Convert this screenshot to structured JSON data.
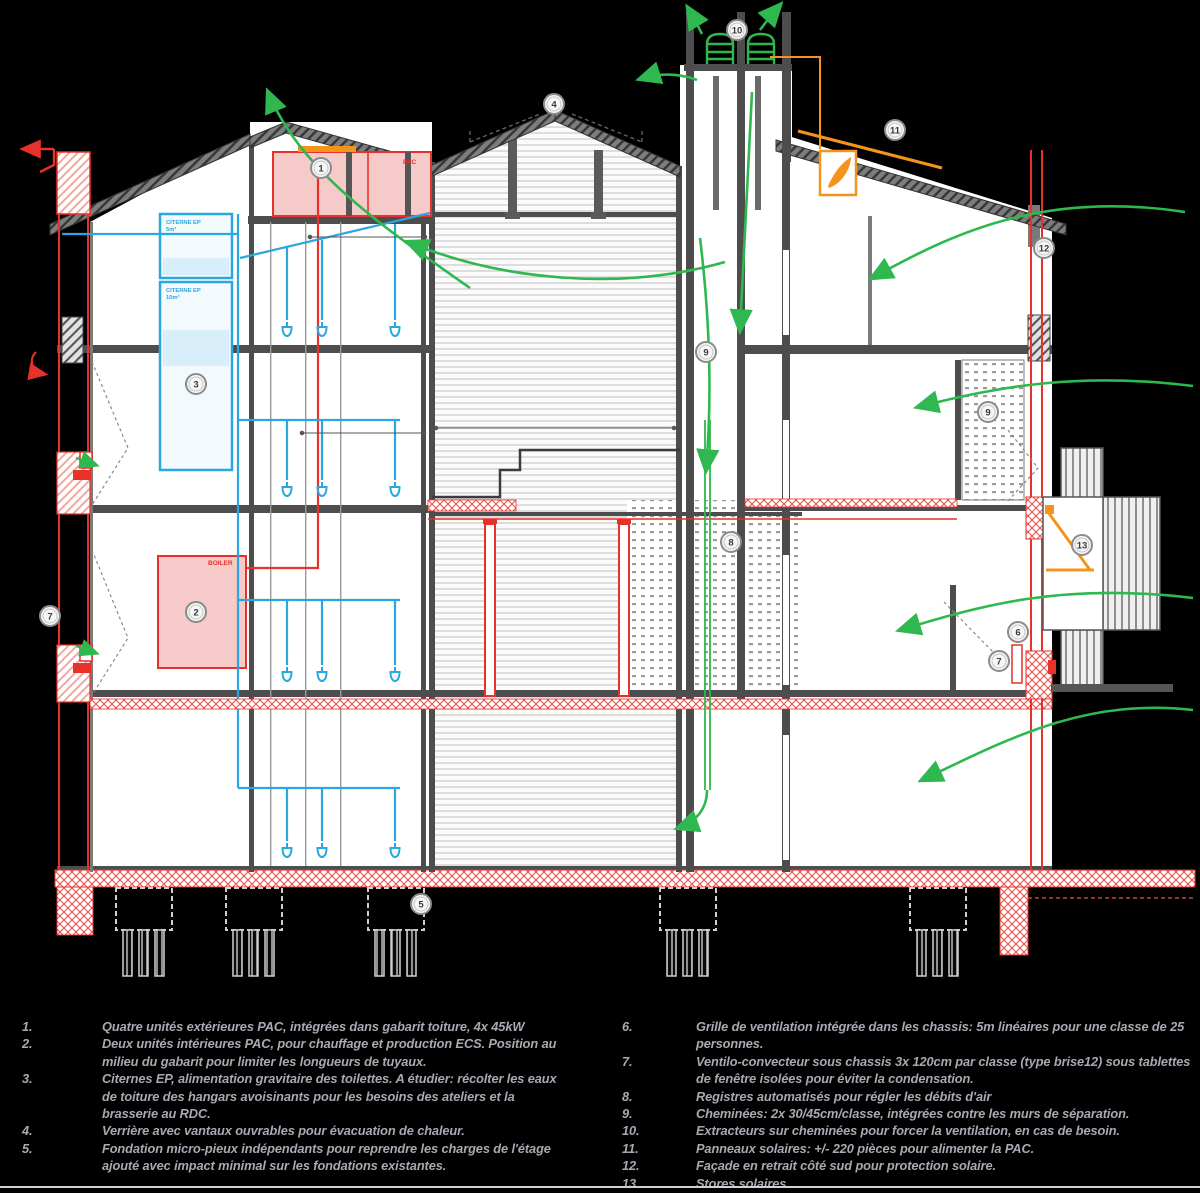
{
  "drawing": {
    "room_labels": {
      "pac": "PAC",
      "boiler": "BOILER",
      "citerne1_name": "CITERNE EP",
      "citerne1_vol": "5m³",
      "citerne2_name": "CITERNE EP",
      "citerne2_vol": "10m³"
    },
    "markers": {
      "m1": "1",
      "m2": "2",
      "m3": "3",
      "m4": "4",
      "m5": "5",
      "m6": "6",
      "m7": "7",
      "m7b": "7",
      "m8": "8",
      "m9": "9",
      "m9b": "9",
      "m10": "10",
      "m11": "11",
      "m12": "12",
      "m13": "13"
    },
    "colors": {
      "new_construction_red": "#e8312a",
      "water_blue": "#2aa7e0",
      "airflow_green": "#2fb84f",
      "solar_orange": "#f5941d",
      "wall_gray": "#4d4d4d"
    }
  },
  "legend": {
    "items_left": [
      {
        "num": "1.",
        "text": "Quatre unités extérieures PAC, intégrées dans gabarit toiture, 4x 45kW"
      },
      {
        "num": "2.",
        "text": "Deux unités intérieures PAC, pour chauffage et production ECS. Position au milieu du gabarit pour limiter les longueurs de tuyaux."
      },
      {
        "num": "3.",
        "text": "Citernes EP, alimentation gravitaire des toilettes. A étudier: récolter les eaux de toiture des hangars avoisinants pour les besoins des ateliers et la brasserie au RDC."
      },
      {
        "num": "4.",
        "text": "Verrière avec vantaux ouvrables pour évacuation de chaleur."
      },
      {
        "num": "5.",
        "text": "Fondation micro-pieux indépendants pour reprendre les charges de l'étage ajouté avec impact minimal sur les fondations existantes."
      }
    ],
    "items_right": [
      {
        "num": "6.",
        "text": "Grille de ventilation intégrée dans les chassis: 5m linéaires pour une classe de 25 personnes."
      },
      {
        "num": "7.",
        "text": "Ventilo-convecteur sous chassis 3x 120cm par classe (type brise12) sous tablettes de fenêtre isolées pour éviter la condensation."
      },
      {
        "num": "8.",
        "text": "Registres automatisés pour régler les débits d'air"
      },
      {
        "num": "9.",
        "text": "Cheminées: 2x 30/45cm/classe, intégrées contre les murs de séparation."
      },
      {
        "num": "10.",
        "text": "Extracteurs sur cheminées pour forcer la ventilation, en cas de besoin."
      },
      {
        "num": "11.",
        "text": "Panneaux solaires: +/- 220 pièces pour alimenter la PAC."
      },
      {
        "num": "12.",
        "text": "Façade en retrait côté sud pour protection solaire."
      },
      {
        "num": "13.",
        "text": "Stores solaires"
      }
    ]
  }
}
